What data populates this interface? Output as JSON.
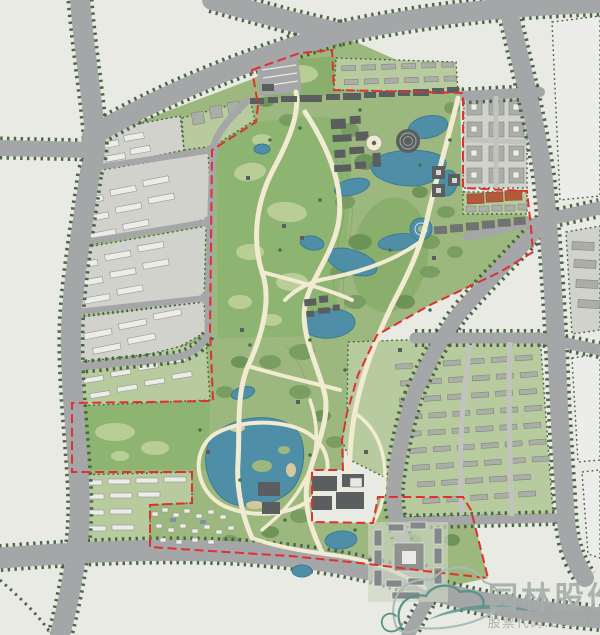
{
  "watermark": {
    "company": "园林股份",
    "stock_label": "股票代码:605303"
  },
  "map": {
    "kind": "landscape-masterplan-site-plan",
    "boundary_style": "red-dashed-project-limit",
    "feature_icons": [
      "park-greenland",
      "meadow-field",
      "forest-trees",
      "lake-water",
      "walking-path",
      "city-road",
      "street-tree-row",
      "residential-slab-building",
      "courtyard-building",
      "dark-civic-building",
      "sports-court",
      "village-houses",
      "roundabout",
      "parking-lot",
      "amphitheater",
      "formal-campus"
    ]
  },
  "colors": {
    "bg": "#e9eae4",
    "road": "#a5a6a8",
    "road_minor": "#c2c3bf",
    "road_edge_tree": "#42603f",
    "park_base": "#9db87f",
    "meadow": "#8db471",
    "meadow_patch": "#bad098",
    "lawn": "#88ae6c",
    "forest": "#74985d",
    "forest_dark": "#648b50",
    "contour": "#7d9e65",
    "water": "#4e8fa7",
    "water_edge": "#3a7890",
    "sand": "#d6c79e",
    "path_cream": "#f0ebd1",
    "boundary_red": "#e03030",
    "block_gray": "#d2d2cd",
    "block_green": "#b7cb9e",
    "empty_block": "#ecedea",
    "slab_white": "#ecede9",
    "slab_gray": "#abaea6",
    "dark_building": "#5b5e5f",
    "campus_gray": "#85888a",
    "court_clay": "#b2593a",
    "village_white": "#edeeea",
    "tree_dot": "#4d6e4b",
    "watermark_text": "#a5aeaa",
    "logo_teal": "#579387",
    "logo_ghost": "#a9bcb2"
  }
}
